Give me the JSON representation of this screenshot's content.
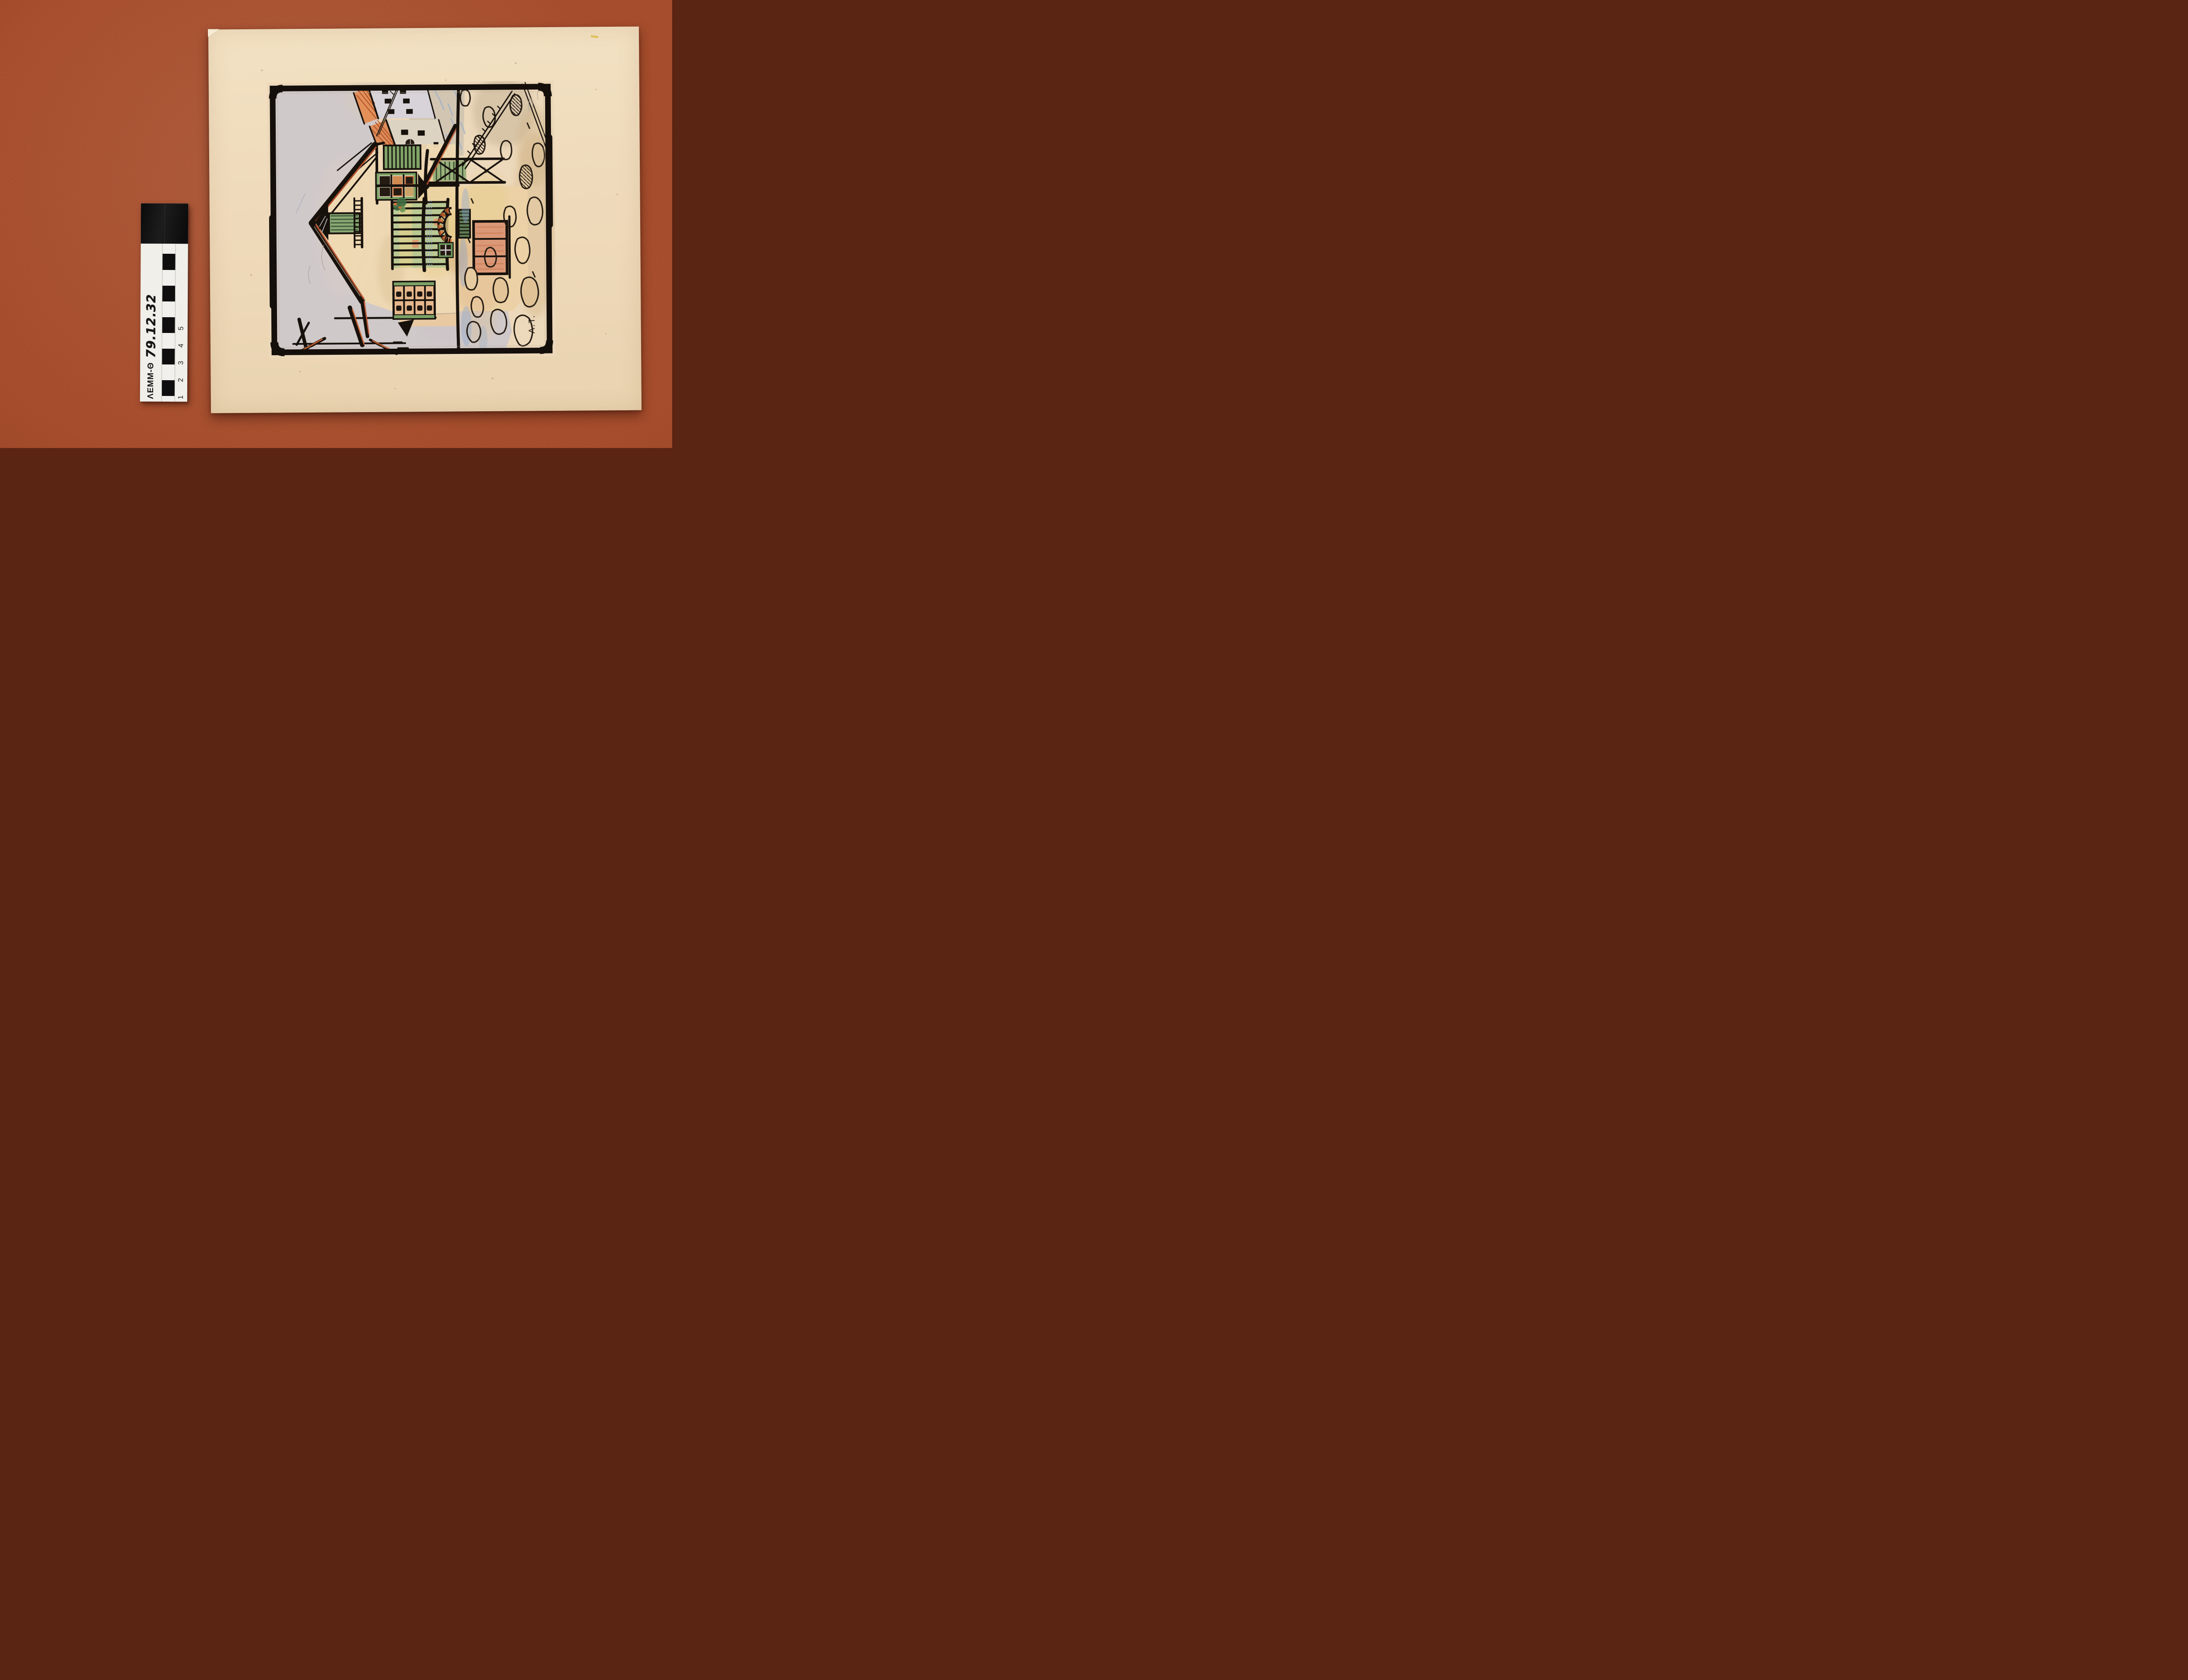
{
  "meta": {
    "description": "Museum documentation photograph: child's ink-and-watercolor drawing of a house with fence, arched doorway, stone wall and street with tiled-roof buildings, mounted on a cream board, photographed rotated 90 degrees counter-clockwise on rust-red fabric with a photographic scale bar."
  },
  "fabric": {
    "color": "#a84d2b"
  },
  "board": {
    "color": "#eed9b9"
  },
  "scale_bar": {
    "collection_code": "ΛΕΜΜ-Θ",
    "inventory_number": "79.12.32",
    "ticks": "1 2 3 4 5",
    "body_color": "#f0efea",
    "end_block_color": "#0e0e0e"
  },
  "artwork": {
    "signature": "A.T.",
    "palette": {
      "ink": "#17110c",
      "paper": "#ecd8ba",
      "sky_wash": "#cfc8ca",
      "shutter_green": "#7ba266",
      "dark_green": "#44603f",
      "brick_orange": "#d96a33",
      "roof_red": "#c2552e",
      "door_salmon": "#db9876",
      "wall_yellow": "#e6c87c",
      "crayon_blue": "#8fa8cc",
      "wash_tan": "#d8bc90",
      "crayon_purple": "#7a55a0"
    }
  }
}
